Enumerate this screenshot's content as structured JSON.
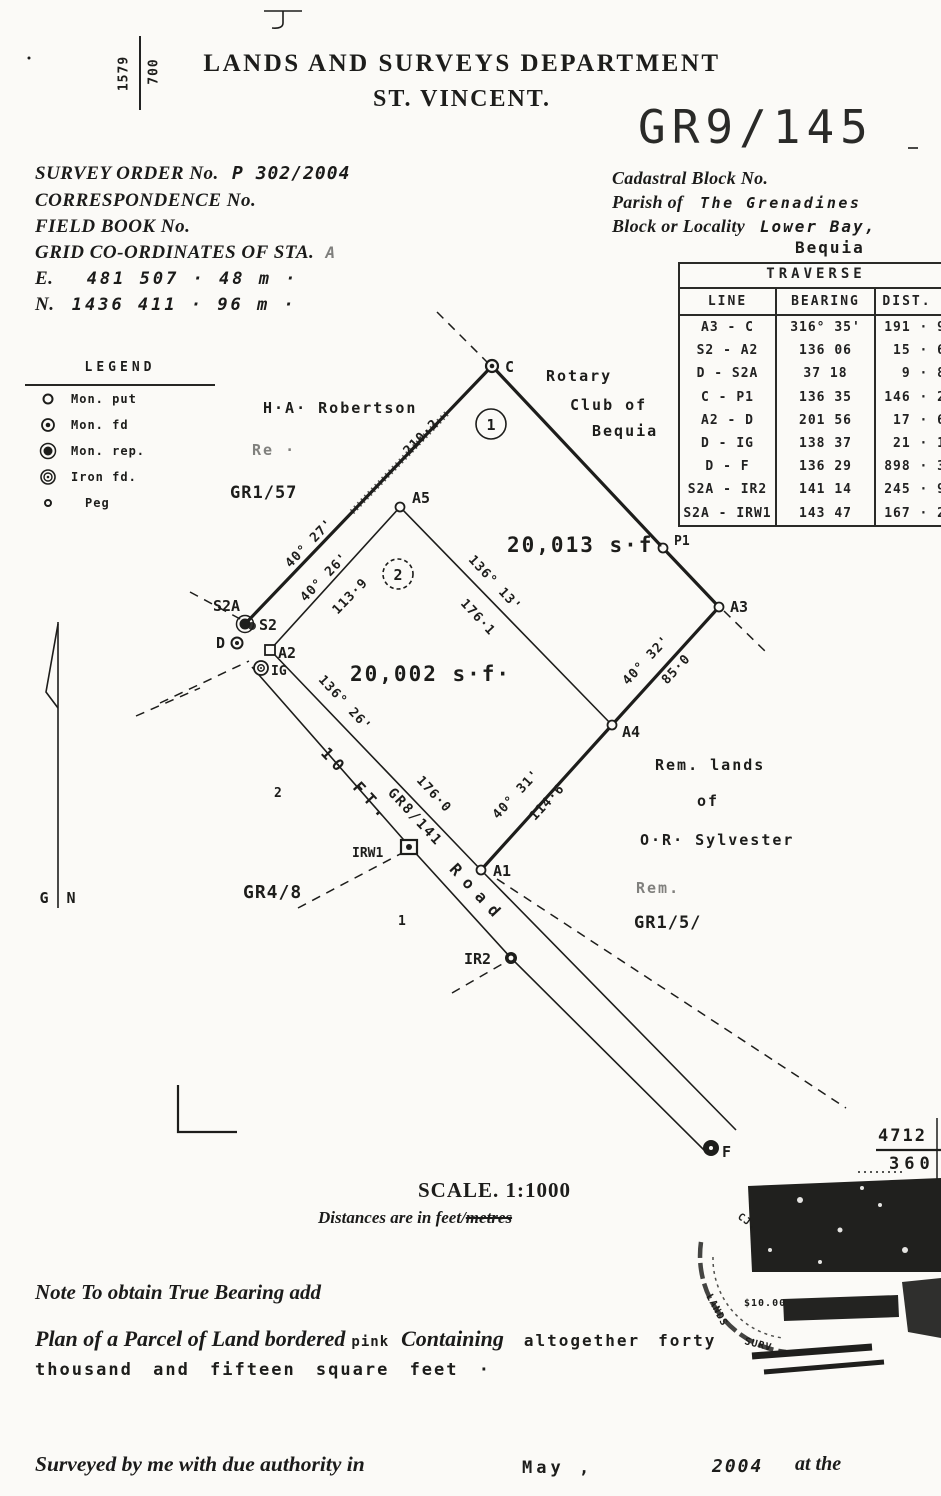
{
  "page": {
    "background": "#fbfaf7",
    "ink": "#1d1d1b"
  },
  "header": {
    "margin_left_top": "1579",
    "margin_left_bottom": "700",
    "department": "LANDS AND SURVEYS DEPARTMENT",
    "territory": "ST. VINCENT.",
    "plan_number": "GR9/145"
  },
  "survey_info": {
    "survey_order_label": "SURVEY ORDER No.",
    "survey_order_value": "P 302/2004",
    "correspondence_label": "CORRESPONDENCE No.",
    "field_book_label": "FIELD BOOK No.",
    "grid_label": "GRID CO-ORDINATES OF STA.",
    "grid_station": "A",
    "easting_label": "E.",
    "easting_value": "481 507 · 48 m ·",
    "northing_label": "N.",
    "northing_value": "1436 411 · 96 m ·"
  },
  "location_info": {
    "cadastral_label": "Cadastral Block No.",
    "parish_label": "Parish of",
    "parish_value": "The Grenadines",
    "block_label": "Block or Locality",
    "block_value": "Lower Bay,",
    "block_value_2": "Bequia"
  },
  "traverse_table": {
    "title": "TRAVERSE",
    "columns": [
      "LINE",
      "BEARING",
      "DIST."
    ],
    "rows": [
      {
        "line": "A3 - C",
        "bearing": "316° 35'",
        "dist": "191 · 9"
      },
      {
        "line": "S2 - A2",
        "bearing": "136 06",
        "dist": "15 · 6"
      },
      {
        "line": "D - S2A",
        "bearing": "37 18",
        "dist": "9 · 8"
      },
      {
        "line": "C - P1",
        "bearing": "136 35",
        "dist": "146 · 2"
      },
      {
        "line": "A2 - D",
        "bearing": "201 56",
        "dist": "17 · 6"
      },
      {
        "line": "D - IG",
        "bearing": "138 37",
        "dist": "21 · 1"
      },
      {
        "line": "D - F",
        "bearing": "136 29",
        "dist": "898 · 3"
      },
      {
        "line": "S2A - IR2",
        "bearing": "141 14",
        "dist": "245 · 9"
      },
      {
        "line": "S2A - IRW1",
        "bearing": "143 47",
        "dist": "167 · 2"
      }
    ]
  },
  "legend": {
    "title": "LEGEND",
    "items": [
      {
        "symbol": "mon-put-icon",
        "label": "Mon. put"
      },
      {
        "symbol": "mon-fd-icon",
        "label": "Mon. fd"
      },
      {
        "symbol": "mon-rep-icon",
        "label": "Mon. rep."
      },
      {
        "symbol": "iron-fd-icon",
        "label": "Iron fd."
      },
      {
        "symbol": "peg-icon",
        "label": "Peg"
      }
    ]
  },
  "north_arrow": {
    "left": "G",
    "right": "N"
  },
  "plan": {
    "points": {
      "c": "C",
      "p1": "P1",
      "a3": "A3",
      "a4": "A4",
      "a5": "A5",
      "a1": "A1",
      "a2": "A2",
      "s2a": "S2A",
      "s2": "S2",
      "d": "D",
      "ig": "IG",
      "irw1": "IRW1",
      "ir2": "IR2",
      "f": "F"
    },
    "parcels": {
      "p1_number": "1",
      "p1_area": "20,013 s·f·",
      "p2_number": "2",
      "p2_area": "20,002 s·f·"
    },
    "dims": {
      "s2a_c_bearing": "40° 27'",
      "s2a_c_dist": "210·2",
      "a2_a5_bearing": "40° 26'",
      "a2_a5_dist": "113·9",
      "a5_a4_bearing": "136°  13'",
      "a5_a4_dist": "176·1",
      "a4_a3_bearing": "40° 32'",
      "a4_a3_dist": "85·0",
      "a1_a4_bearing": "40° 31'",
      "a1_a4_dist": "114·6",
      "road_bearing": "136° 26'",
      "road_dist": "176·0"
    },
    "labels": {
      "adjoiner_nw_1": "H·A· Robertson",
      "adjoiner_nw_2": "Re ·",
      "adjoiner_nw_ref": "GR1/57",
      "adjoiner_ne_1": "Rotary",
      "adjoiner_ne_2": "Club of",
      "adjoiner_ne_3": "Bequia",
      "adjoiner_se_1": "Rem. lands",
      "adjoiner_se_2": "of",
      "adjoiner_se_3": "O·R· Sylvester",
      "adjoiner_s_1": "Rem.",
      "adjoiner_s_ref": "GR1/5/",
      "adjoiner_sw_ref": "GR4/8",
      "road_name_1": "10 FT.",
      "road_name_2": "Road",
      "road_ref": "GR8/141",
      "lot_mark_1": "1",
      "lot_mark_2": "2"
    }
  },
  "margin_fraction": {
    "numerator": "4712",
    "denominator": "360"
  },
  "scale_block": {
    "scale": "SCALE. 1:1000",
    "units_prefix": "Distances are in feet/",
    "units_struck": "metres"
  },
  "stamp": {
    "fee": "$10.00",
    "text_1": "CJ.",
    "text_2": "LANDS",
    "text_3": "SURV"
  },
  "notes": {
    "bearing_note": "Note To obtain True Bearing add",
    "description_1": "Plan of a Parcel of Land bordered",
    "description_color": "pink",
    "description_2": "Containing",
    "description_3": "altogether",
    "description_4": "forty",
    "description_5": "thousand and fifteen square feet ·",
    "surveyed_prefix": "Surveyed by me with due authority in",
    "surveyed_month": "May ,",
    "surveyed_year": "2004",
    "surveyed_suffix": "at the"
  }
}
